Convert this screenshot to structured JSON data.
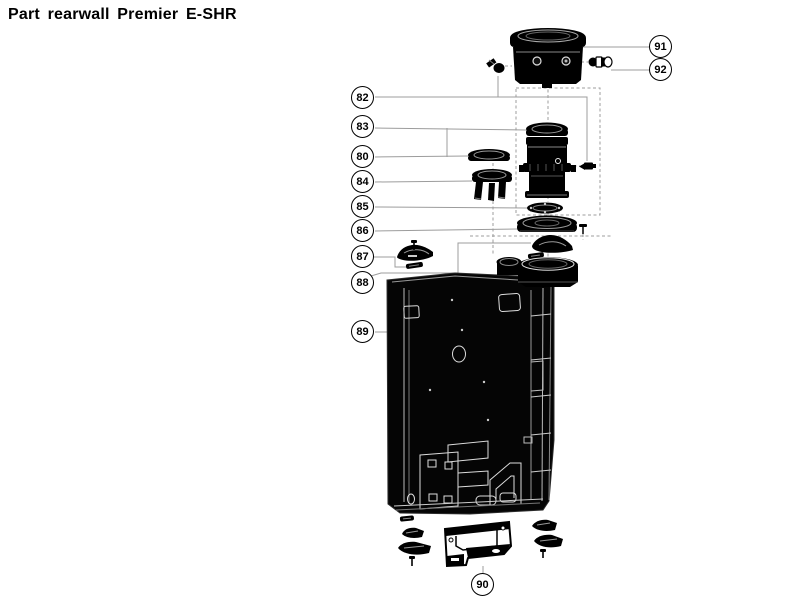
{
  "title": "Part rearwall Premier E-SHR",
  "colors": {
    "background": "#ffffff",
    "ink": "#000000",
    "leader": "#9c9c9c"
  },
  "callouts": [
    {
      "label": "91",
      "x": 661,
      "y": 47
    },
    {
      "label": "92",
      "x": 661,
      "y": 70
    },
    {
      "label": "82",
      "x": 363,
      "y": 98
    },
    {
      "label": "83",
      "x": 363,
      "y": 127
    },
    {
      "label": "80",
      "x": 363,
      "y": 157
    },
    {
      "label": "84",
      "x": 363,
      "y": 182
    },
    {
      "label": "85",
      "x": 363,
      "y": 207
    },
    {
      "label": "86",
      "x": 363,
      "y": 231
    },
    {
      "label": "87",
      "x": 363,
      "y": 257
    },
    {
      "label": "88",
      "x": 363,
      "y": 283
    },
    {
      "label": "89",
      "x": 363,
      "y": 332
    },
    {
      "label": "90",
      "x": 483,
      "y": 585
    }
  ]
}
